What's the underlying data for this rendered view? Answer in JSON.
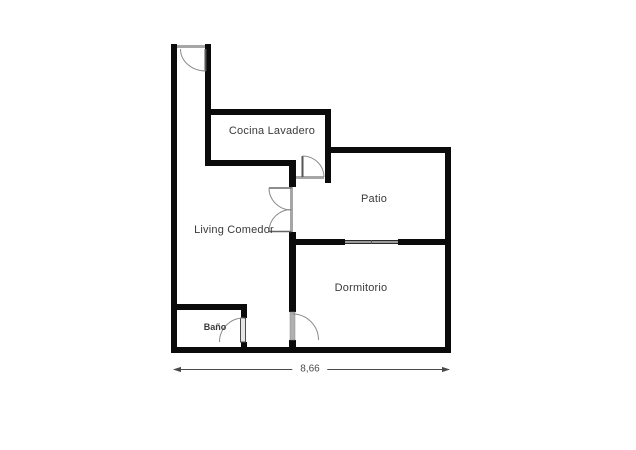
{
  "floorplan": {
    "rooms": {
      "cocina": {
        "label": "Cocina Lavadero"
      },
      "patio": {
        "label": "Patio"
      },
      "living": {
        "label": "Living Comedor"
      },
      "dormitorio": {
        "label": "Dormitorio"
      },
      "bano": {
        "label": "Baño"
      }
    },
    "dimension": {
      "width_label": "8,66"
    },
    "features": {
      "doors": [
        "entry-door",
        "cocina-door",
        "french-double-door",
        "bano-door",
        "dormitorio-door"
      ],
      "windows": [
        "patio-dormitorio-window"
      ]
    },
    "colors": {
      "wall": "#0b0b0b",
      "door_gray": "#a6a6a6",
      "arc": "#8c8c8c",
      "text": "#3a3a3a",
      "dim": "#4a4a4a",
      "bg": "#ffffff"
    }
  }
}
